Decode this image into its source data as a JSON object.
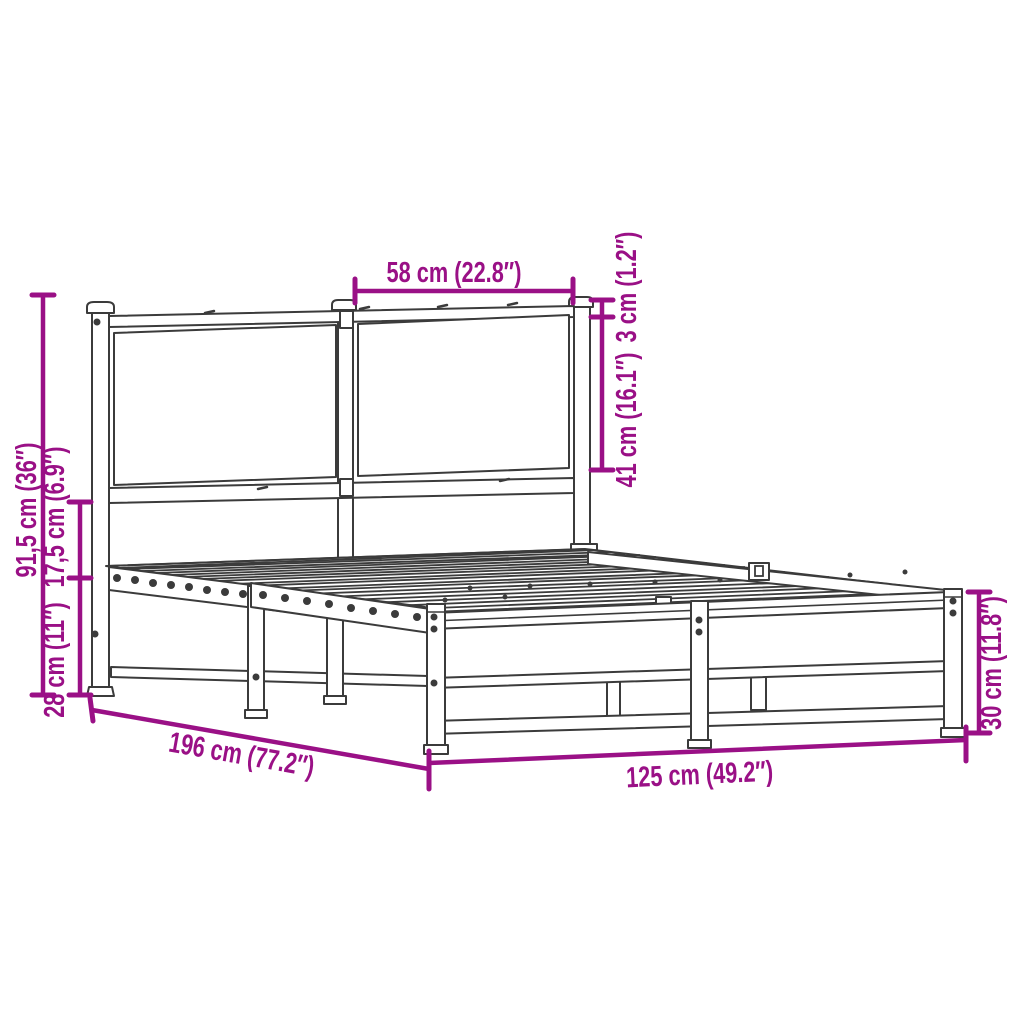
{
  "diagram": {
    "title": "metal bed frame with headboard - dimension diagram",
    "colors": {
      "background": "#ffffff",
      "line": "#3b3b3b",
      "dimension": "#9a1086"
    },
    "labels": {
      "headboard_height": "91,5 cm (36″)",
      "side_rail_height": "17,5 cm (6.9″)",
      "under_bed_clearance": "28 cm (11″)",
      "headboard_panel_width": "58 cm (22.8″)",
      "post_cap_gap": "3 cm (1.2″)",
      "headboard_panel_height": "41 cm (16.1″)",
      "footboard_height": "30 cm (11.8″)",
      "bed_length": "196 cm (77.2″)",
      "bed_width": "125 cm (49.2″)"
    }
  }
}
